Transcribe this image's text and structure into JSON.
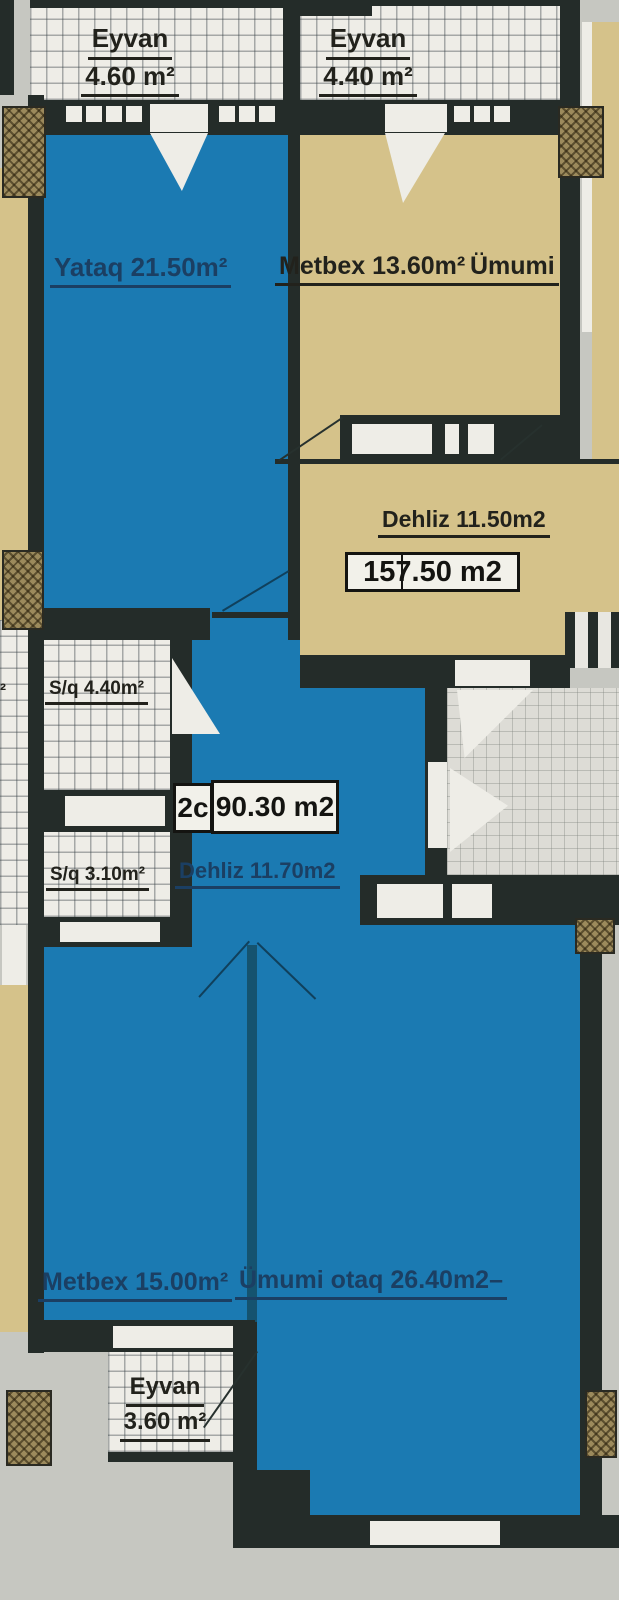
{
  "palette": {
    "wall": "#242c29",
    "room_blue": "#1b7ab2",
    "room_tan": "#d5c28a",
    "background": "#c6c7c1",
    "hatch_bg": "#eeede7",
    "column_brown": "#9c8a5c",
    "text_navy": "#1b3f63",
    "text_black": "#22221c"
  },
  "labels": {
    "eyvan_top_left": {
      "name": "Eyvan",
      "area": "4.60 m²"
    },
    "eyvan_top_right": {
      "name": "Eyvan",
      "area": "4.40 m²"
    },
    "yataq": "Yataq 21.50m²",
    "metbex_upper": "Metbex 13.60m²",
    "neighbor_fragment_right": "Ümumi",
    "neighbor_fragment_left": "²",
    "dehliz_upper": "Dehliz 11.50m2",
    "total_area": "157.50 m2",
    "sq_upper": "S/q 4.40m²",
    "unit_type": "2c",
    "unit_area": "90.30 m2",
    "sq_lower": "S/q 3.10m²",
    "dehliz_lower": "Dehliz 11.70m2",
    "metbex_lower": "Metbex 15.00m²",
    "umumi_otaq": "Ümumi otaq 26.40m2–",
    "eyvan_bottom": {
      "name": "Eyvan",
      "area": "3.60 m²"
    }
  }
}
